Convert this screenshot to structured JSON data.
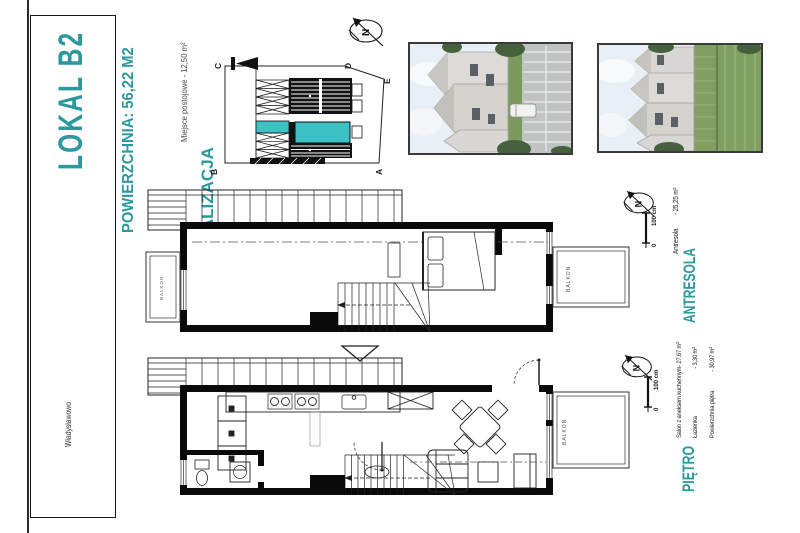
{
  "colors": {
    "accent": "#2a989c",
    "unitfill": "#3ec1c5"
  },
  "title_block": {
    "unit": "LOKAL  B2",
    "area": "POWIERZCHNIA: 56,22 M2",
    "city": "Władysławowo"
  },
  "location": {
    "heading": "LOKALIZACJA",
    "parking": "Miejsce postojowe - 12,50 m²",
    "corners": {
      "a": "A",
      "b": "B",
      "c": "C",
      "d": "D",
      "e": "E"
    }
  },
  "antresola": {
    "heading": "ANTRESOLA",
    "room": "Antresola",
    "room_area": "- 25,25 m²",
    "balcony": "BALKON",
    "scale_top": "100 cm",
    "scale_zero": "0",
    "north": "N"
  },
  "pietro": {
    "heading": "PIĘTRO",
    "rooms": [
      {
        "name": "Salon z aneksem kuchennym",
        "area": "- 27,67 m²"
      },
      {
        "name": "Łazienka",
        "area": "- 3,30 m²"
      },
      {
        "name": "Powierzchnia piętra",
        "area": "- 30,97 m²"
      }
    ],
    "balcony": "BALKON",
    "scale_top": "100 cm",
    "scale_zero": "0",
    "north": "N"
  },
  "site_north": "N"
}
